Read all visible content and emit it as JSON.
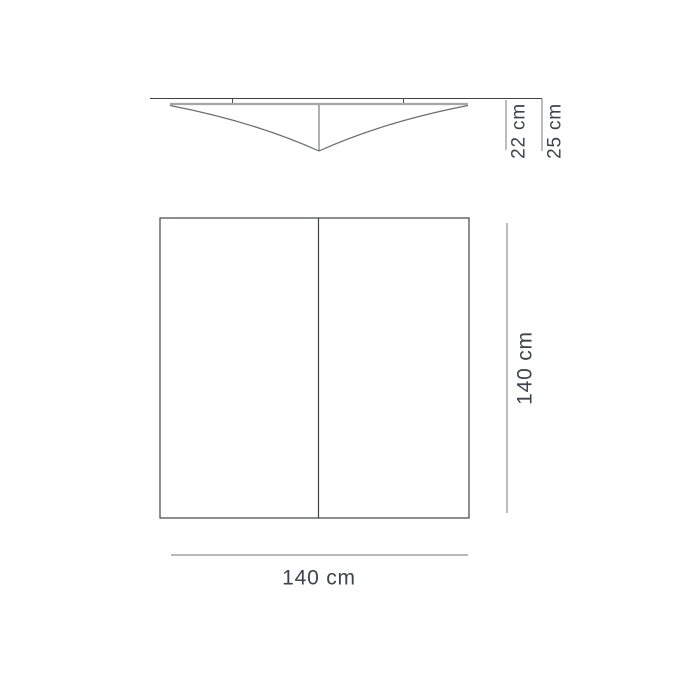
{
  "diagram": {
    "type": "product-dimension-drawing",
    "views": [
      {
        "id": "side-profile-view",
        "description": "curved ceiling fixture profile"
      },
      {
        "id": "plan-view",
        "description": "square bottom outline split in two panels"
      }
    ]
  },
  "labels": {
    "shade_depth": "22 cm",
    "total_depth": "25 cm",
    "plan_height": "140 cm",
    "plan_width": "140 cm"
  },
  "colors": {
    "background": "#ffffff",
    "outline": "#3f4246",
    "curve": "#6a6d70",
    "dimension_line": "#8f8f8f",
    "shade_top_edge": "#a6a6a6",
    "text": "#3e434c"
  }
}
